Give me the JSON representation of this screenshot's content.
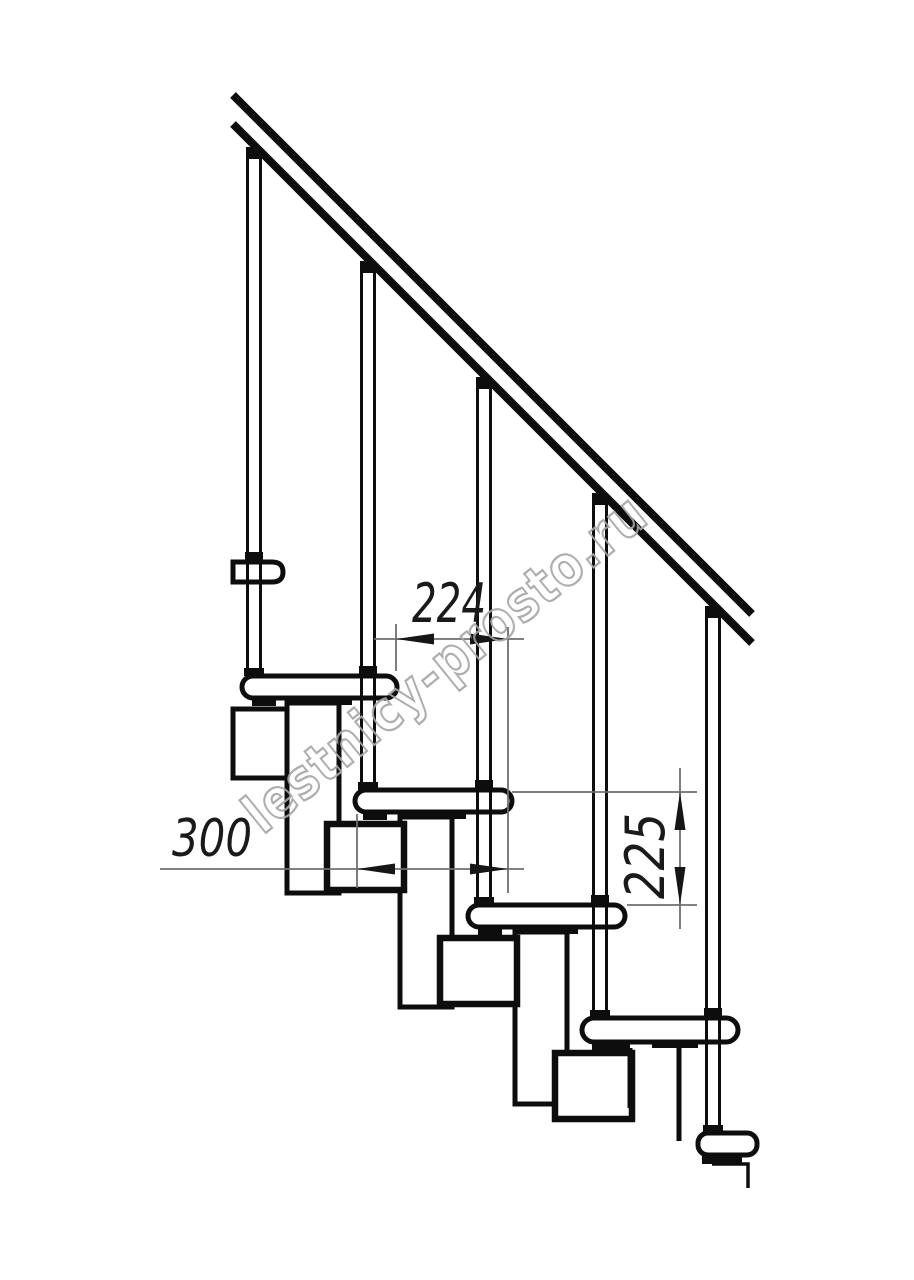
{
  "drawing": {
    "kind": "staircase-side-elevation",
    "background": "#ffffff",
    "line_color": "#0d0d0d",
    "dim_line_color": "#6f6f6f",
    "dim_text_color": "#1a1a1a",
    "tread_count": 6,
    "baluster_count": 5
  },
  "dims": {
    "going": {
      "label": "224",
      "orientation": "horizontal"
    },
    "depth": {
      "label": "300",
      "orientation": "horizontal"
    },
    "riser": {
      "label": "225",
      "orientation": "vertical"
    }
  },
  "watermark": {
    "text": "lestnicy-prosto.ru",
    "color": "#a6a6a6"
  }
}
